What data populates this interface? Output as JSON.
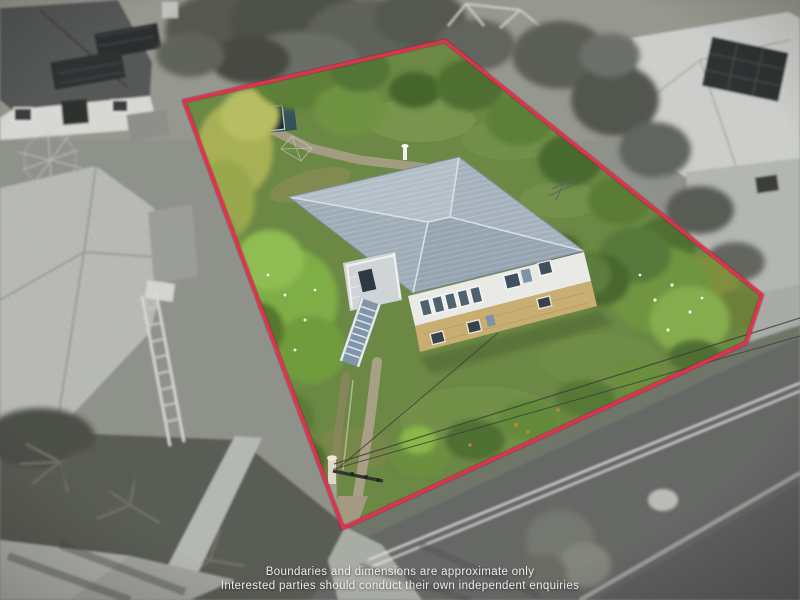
{
  "disclaimer": {
    "line1": "Boundaries and dimensions are approximate only",
    "line2": "Interested parties should conduct their own independent enquiries"
  },
  "boundary": {
    "points": "184,101 445,41 762,295 746,343 343,528",
    "color": "#e1314e"
  },
  "colors": {
    "house_roof": "#a7b4bf",
    "house_wall": "#e9eae6",
    "house_brick": "#c9ae72",
    "stairs_blue": "#7f95a9",
    "shed_teal": "#32535a",
    "lawn_green": "#6b8845",
    "road_gray": "#666866",
    "road_marking": "#e6e7e4",
    "concrete_path": "#a89f87"
  }
}
